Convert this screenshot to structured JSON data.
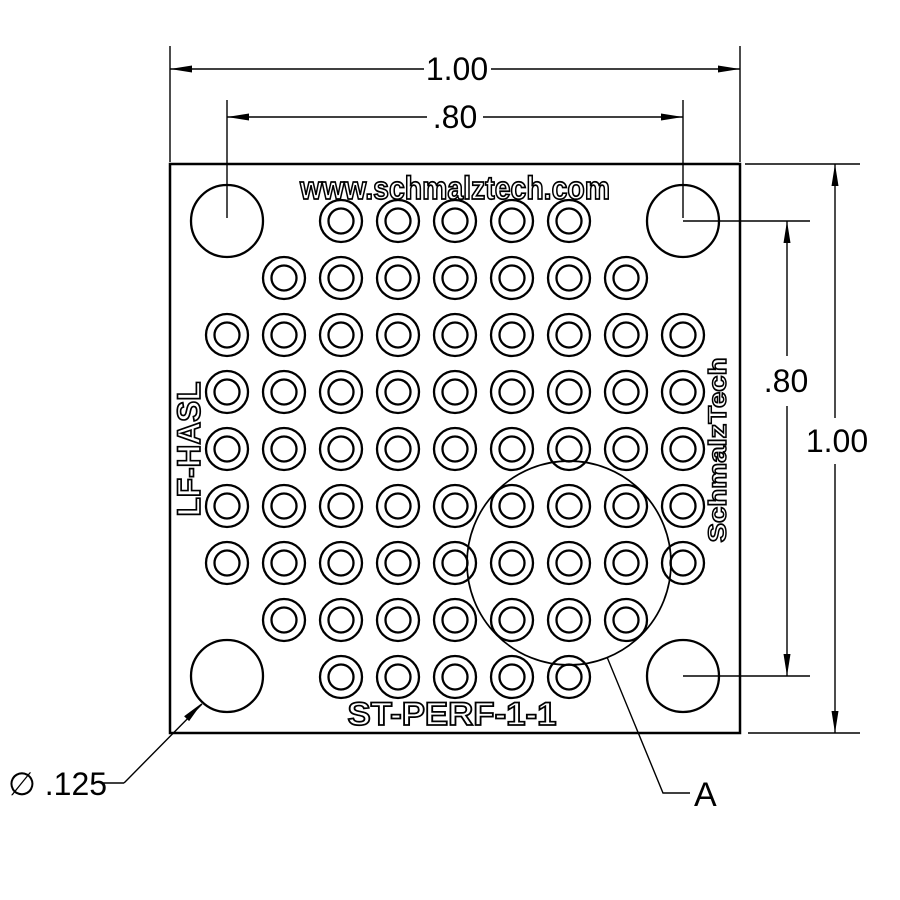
{
  "labels": {
    "website": "www.schmalztech.com",
    "part_number": "ST-PERF-1-1",
    "finish": "LF-HASL",
    "brand": "SchmalzTech",
    "detail": "A",
    "hole_callout": "∅ .125"
  },
  "dimensions": {
    "top_total": "1.00",
    "top_pads": ".80",
    "right_total": "1.00",
    "right_pads": ".80"
  },
  "geometry": {
    "board": {
      "x": 170,
      "y": 164,
      "width": 570,
      "height": 569
    },
    "grid": {
      "origin_x": 170,
      "origin_y": 164,
      "pitch": 57,
      "pad_outer_r": 21,
      "pad_inner_r": 12.5,
      "rows": [
        {
          "row": 1,
          "from": 3,
          "to": 7
        },
        {
          "row": 2,
          "from": 2,
          "to": 8
        },
        {
          "row": 3,
          "from": 1,
          "to": 9
        },
        {
          "row": 4,
          "from": 1,
          "to": 9
        },
        {
          "row": 5,
          "from": 1,
          "to": 9
        },
        {
          "row": 6,
          "from": 1,
          "to": 9
        },
        {
          "row": 7,
          "from": 1,
          "to": 9
        },
        {
          "row": 8,
          "from": 2,
          "to": 8
        },
        {
          "row": 9,
          "from": 3,
          "to": 7
        }
      ]
    },
    "corner_holes": {
      "r": 36,
      "centers": [
        [
          227,
          221
        ],
        [
          683,
          221
        ],
        [
          227,
          676
        ],
        [
          683,
          676
        ]
      ]
    },
    "detail_circle": {
      "cx": 569,
      "cy": 563,
      "r": 102
    }
  }
}
